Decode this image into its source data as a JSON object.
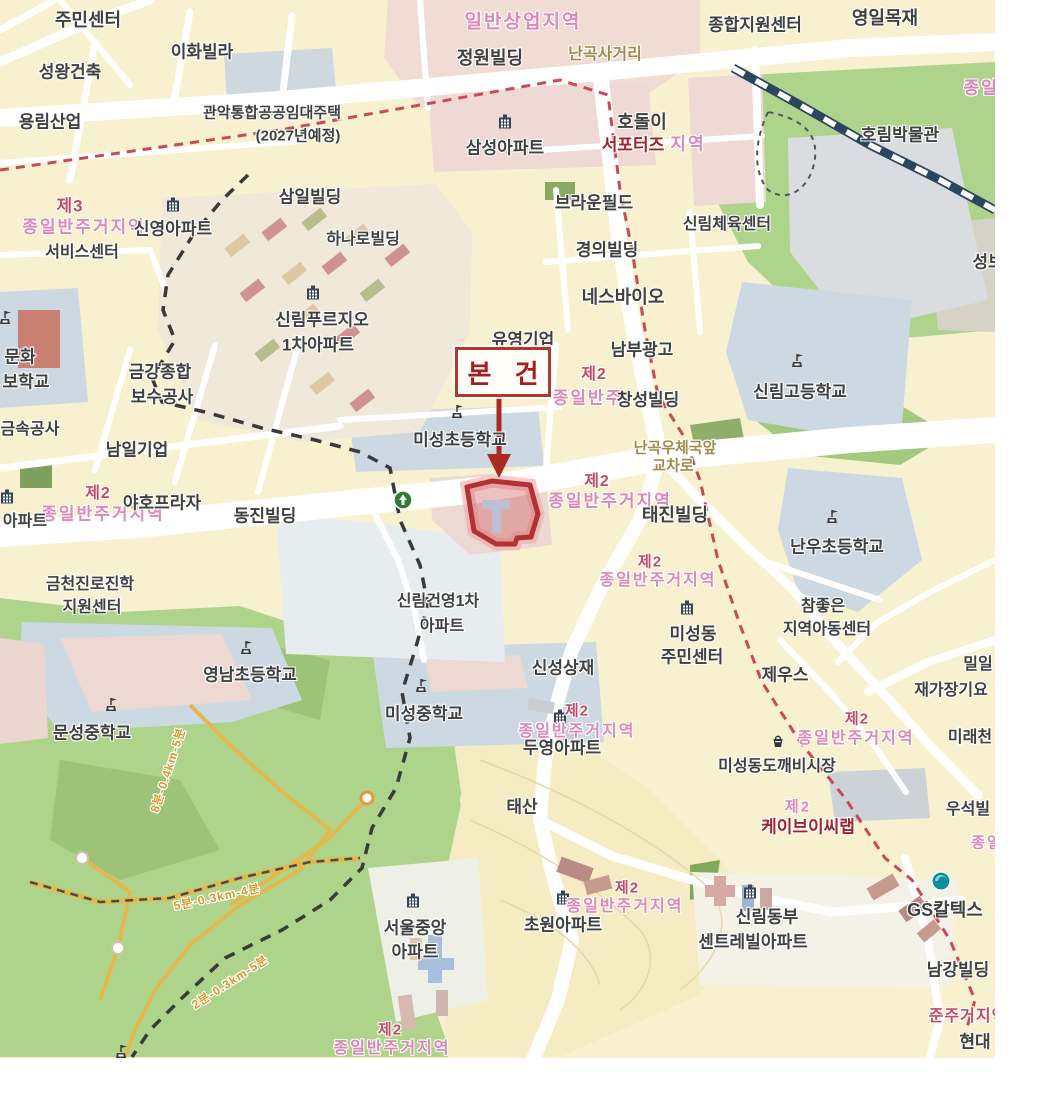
{
  "annotation": {
    "subject_label": "본 건"
  },
  "colors": {
    "base_yellow": "#f8f1cf",
    "road_white": "#ffffff",
    "park_green": "#aed48c",
    "school_gray": "#cdd9e2",
    "commercial_pink": "#f1dcd3",
    "subject_red": "#b5372c",
    "zone_pink": "#dc84b4",
    "zone_red": "#bf4e63",
    "railway_navy": "#2b4560",
    "boundary_black": "#3a3a3a",
    "trail_yellow": "#e3b94d"
  },
  "map": {
    "labels": [
      [
        "일반상업지역",
        523,
        22,
        "zp",
        19
      ],
      [
        "종일반주거지역",
        84,
        227,
        "zp",
        17
      ],
      [
        "제3",
        70,
        206,
        "zr",
        17
      ],
      [
        "지역",
        688,
        144,
        "zp",
        17
      ],
      [
        "종일반",
        990,
        88,
        "zp",
        17
      ],
      [
        "종일반주",
        588,
        398,
        "zp",
        17
      ],
      [
        "제2",
        594,
        375,
        "zr",
        16
      ],
      [
        "종일반주거지역",
        610,
        501,
        "zp",
        17
      ],
      [
        "제2",
        597,
        482,
        "zr",
        16
      ],
      [
        "종일반주거지역",
        658,
        581,
        "zp",
        16
      ],
      [
        "제2",
        650,
        562,
        "zr",
        15
      ],
      [
        "종일반주거지역",
        103,
        514,
        "zp",
        17
      ],
      [
        "제2",
        98,
        494,
        "zr",
        16
      ],
      [
        "종일반주거지역",
        577,
        732,
        "zp",
        16
      ],
      [
        "제2",
        577,
        711,
        "zr",
        15
      ],
      [
        "종일반주거지역",
        856,
        739,
        "zp",
        16
      ],
      [
        "제2",
        857,
        719,
        "zr",
        15
      ],
      [
        "제2",
        798,
        807,
        "zp",
        15
      ],
      [
        "종일반주거지역",
        625,
        907,
        "zp",
        16
      ],
      [
        "제2",
        627,
        888,
        "zr",
        15
      ],
      [
        "종일반주거지역",
        392,
        1049,
        "zp",
        16
      ],
      [
        "제2",
        390,
        1030,
        "zr",
        15
      ],
      [
        "종일",
        987,
        843,
        "zp",
        15
      ],
      [
        "준주거지역",
        968,
        1017,
        "zr",
        16
      ],
      [
        "8분-0.4km-5분",
        168,
        770,
        "tr",
        12,
        -72
      ],
      [
        "5분-0.3km-4분",
        217,
        897,
        "tr",
        12,
        -12
      ],
      [
        "2분-0.3km-5분",
        230,
        982,
        "tr",
        12,
        -33
      ],
      [
        "난곡사거리",
        605,
        55,
        "rd",
        16
      ],
      [
        "난곡우체국앞",
        675,
        448,
        "rd",
        15
      ],
      [
        "교차로",
        673,
        466,
        "rd",
        15
      ],
      [
        "주민센터",
        88,
        20,
        "p",
        18
      ],
      [
        "이화빌라",
        202,
        52,
        "p",
        17
      ],
      [
        "성왕건축",
        70,
        72,
        "p",
        17
      ],
      [
        "용림산업",
        50,
        122,
        "p",
        17
      ],
      [
        "관악통합공공임대주택",
        272,
        113,
        "p",
        15
      ],
      [
        "(2027년예정)",
        298,
        136,
        "p",
        15
      ],
      [
        "정원빌딩",
        490,
        58,
        "p",
        18
      ],
      [
        "삼성아파트",
        505,
        148,
        "p",
        17
      ],
      [
        "호돌이",
        642,
        122,
        "p",
        18
      ],
      [
        "종합지원센터",
        755,
        25,
        "p",
        17
      ],
      [
        "영일목재",
        885,
        18,
        "p",
        18
      ],
      [
        "호림박물관",
        900,
        135,
        "p",
        17
      ],
      [
        "삼일빌딩",
        310,
        197,
        "p",
        17
      ],
      [
        "신영아파트",
        173,
        229,
        "p",
        17
      ],
      [
        "하나로빌딩",
        363,
        240,
        "p",
        16
      ],
      [
        "브라운필드",
        594,
        203,
        "p",
        17
      ],
      [
        "신림체육센터",
        727,
        225,
        "p",
        16
      ],
      [
        "경의빌딩",
        607,
        250,
        "p",
        17
      ],
      [
        "네스바이오",
        623,
        297,
        "p",
        18
      ],
      [
        "서비스센터",
        82,
        253,
        "p",
        16
      ],
      [
        "신림푸르지오",
        322,
        320,
        "p",
        17
      ],
      [
        "1차아파트",
        318,
        345,
        "p",
        17
      ],
      [
        "문화",
        20,
        357,
        "p",
        17
      ],
      [
        "보학교",
        26,
        382,
        "p",
        17
      ],
      [
        "금강종합",
        160,
        372,
        "p",
        17
      ],
      [
        "보수공사",
        162,
        397,
        "p",
        17
      ],
      [
        "유영기업",
        523,
        340,
        "p",
        17
      ],
      [
        "남부광고",
        642,
        350,
        "p",
        17
      ],
      [
        "창성빌딩",
        648,
        400,
        "p",
        17
      ],
      [
        "신림고등학교",
        800,
        392,
        "p",
        17
      ],
      [
        "성보",
        988,
        262,
        "p",
        17
      ],
      [
        "미성초등학교",
        460,
        440,
        "p",
        17
      ],
      [
        "남일기업",
        137,
        450,
        "p",
        17
      ],
      [
        "금속공사",
        30,
        430,
        "p",
        16
      ],
      [
        "야호프라자",
        162,
        503,
        "p",
        17
      ],
      [
        "아파트",
        25,
        522,
        "p",
        16
      ],
      [
        "동진빌딩",
        265,
        516,
        "p",
        17
      ],
      [
        "태진빌딩",
        675,
        515,
        "p",
        18
      ],
      [
        "난우초등학교",
        837,
        547,
        "p",
        17
      ],
      [
        "참좋은",
        823,
        607,
        "p",
        16
      ],
      [
        "지역아동센터",
        827,
        630,
        "p",
        16
      ],
      [
        "미성동",
        693,
        634,
        "p",
        17
      ],
      [
        "주민센터",
        692,
        657,
        "p",
        17
      ],
      [
        "신성상재",
        563,
        668,
        "p",
        17
      ],
      [
        "제우스",
        785,
        675,
        "p",
        17
      ],
      [
        "밀일",
        978,
        665,
        "p",
        16
      ],
      [
        "재가장기요",
        951,
        691,
        "p",
        16
      ],
      [
        "미래천",
        970,
        738,
        "p",
        16
      ],
      [
        "영남초등학교",
        250,
        675,
        "p",
        17
      ],
      [
        "문성중학교",
        92,
        733,
        "p",
        17
      ],
      [
        "미성중학교",
        424,
        714,
        "p",
        17
      ],
      [
        "신림건영1차",
        438,
        602,
        "p",
        16
      ],
      [
        "아파트",
        442,
        627,
        "p",
        16
      ],
      [
        "금천진로진학",
        90,
        585,
        "p",
        16
      ],
      [
        "지원센터",
        92,
        608,
        "p",
        16
      ],
      [
        "두영아파트",
        562,
        748,
        "p",
        17
      ],
      [
        "태산",
        522,
        807,
        "p",
        17
      ],
      [
        "미성동도깨비시장",
        777,
        767,
        "p",
        16
      ],
      [
        "우석빌",
        968,
        810,
        "p",
        16
      ],
      [
        "서울중앙",
        415,
        928,
        "p",
        17
      ],
      [
        "아파트",
        415,
        952,
        "p",
        17
      ],
      [
        "초원아파트",
        563,
        925,
        "p",
        17
      ],
      [
        "신림동부",
        767,
        917,
        "p",
        17
      ],
      [
        "센트레빌아파트",
        753,
        942,
        "p",
        17
      ],
      [
        "GS칼텍스",
        945,
        910,
        "p",
        18
      ],
      [
        "남강빌딩",
        958,
        970,
        "p",
        17
      ],
      [
        "현대",
        975,
        1042,
        "p",
        17
      ],
      [
        "서포터즈",
        633,
        145,
        "pr",
        17
      ],
      [
        "케이브이씨랩",
        808,
        827,
        "pr",
        17
      ]
    ],
    "icons": [
      [
        "building",
        505,
        122
      ],
      [
        "building",
        173,
        205
      ],
      [
        "building",
        313,
        293
      ],
      [
        "building",
        7,
        497
      ],
      [
        "building",
        560,
        717
      ],
      [
        "building",
        413,
        901
      ],
      [
        "building",
        563,
        898
      ],
      [
        "building",
        750,
        892
      ],
      [
        "building",
        687,
        608
      ],
      [
        "school",
        798,
        361
      ],
      [
        "school",
        458,
        412
      ],
      [
        "school",
        833,
        517
      ],
      [
        "school",
        247,
        648
      ],
      [
        "school",
        112,
        705
      ],
      [
        "school",
        422,
        686
      ],
      [
        "school",
        6,
        318
      ],
      [
        "school",
        122,
        1052
      ],
      [
        "market",
        778,
        741
      ],
      [
        "gs",
        941,
        881
      ],
      [
        "oneway",
        403,
        500
      ],
      [
        "node_orange",
        367,
        798
      ],
      [
        "node",
        82,
        858
      ],
      [
        "node",
        118,
        948
      ]
    ]
  }
}
